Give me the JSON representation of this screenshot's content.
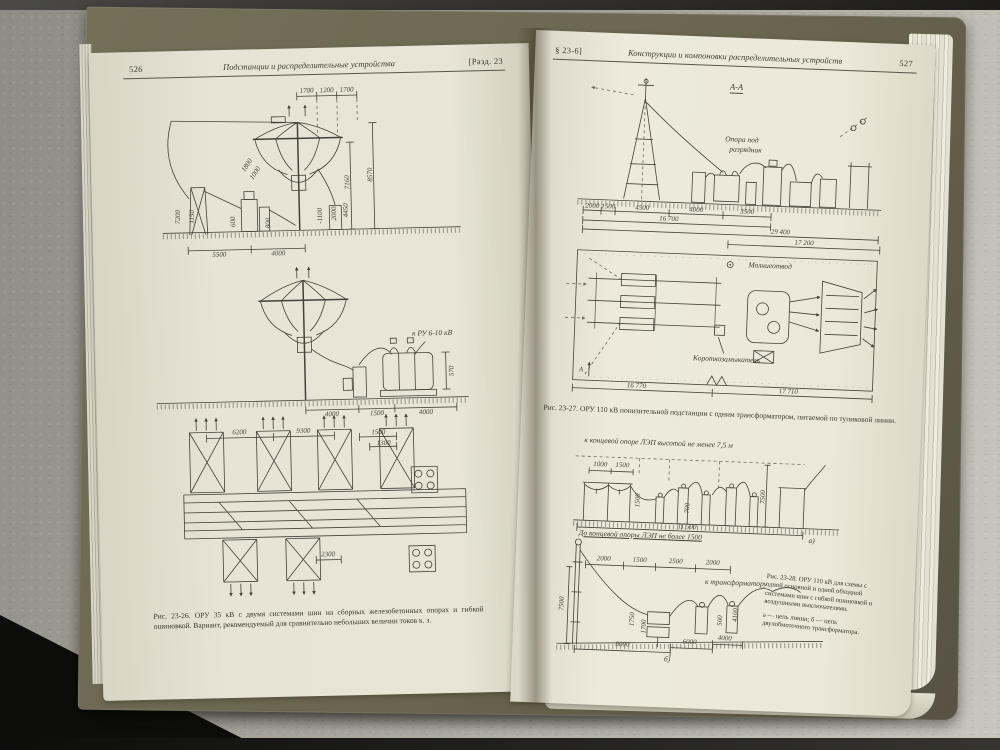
{
  "colors": {
    "cover": "#6a654f",
    "page": "#e8e5d6",
    "fabric": "#b5b2a9",
    "ink": "#44413a"
  },
  "left_page": {
    "page_number": "526",
    "header_title": "Подстанции и распределительные устройства",
    "header_section": "[Разд. 23",
    "fig1": {
      "dims_top": [
        "1700",
        "1200",
        "1700"
      ],
      "dims_left": [
        "7200",
        "1150",
        "600",
        "800"
      ],
      "dims_mid": [
        "1800",
        "1000",
        "-1100",
        "2000",
        "4450"
      ],
      "dims_right": [
        "7160",
        "8570"
      ],
      "dims_bottom": [
        "5500",
        "4000"
      ]
    },
    "fig2": {
      "label": "к РУ 6-10 кВ",
      "dim_right": "570",
      "dims_bottom": [
        "4000",
        "1500",
        "4000"
      ]
    },
    "fig3": {
      "dims_top": [
        "6200",
        "9300",
        "1500",
        "1300"
      ],
      "dim_bottom": "2300"
    },
    "caption": "Рис. 23-26. ОРУ 35 кВ с двумя системами шин на сборных железобетонных опорах и гибкой ошиновкой. Вариант, рекомендуемый для сравнительно небольших величин токов к. з."
  },
  "right_page": {
    "page_number": "527",
    "header_section": "§ 23-6]",
    "header_title": "Конструкции и компоновки распределительных устройств",
    "view_label": "А-А",
    "fig_aa": {
      "label_line1": "Опора под",
      "label_line2": "разрядник",
      "dims_bottom": [
        "2000",
        "1500",
        "4500",
        "4000",
        "3500"
      ],
      "total_1": "16 700",
      "total_2": "29 400"
    },
    "fig_plan": {
      "label_lightning": "Молниеотвод",
      "label_shorter": "Короткозамыкатель",
      "dim_top": "17 200",
      "dims_bottom": [
        "16 770",
        "17 710"
      ],
      "cut_label": "А"
    },
    "caption_27": "Рис. 23-27. ОРУ 110 кВ понизительной подстанции с одним трансформатором, питаемой по тупиковой линии.",
    "fig_a": {
      "label_top": "к концевой опоре ЛЭП высотой не менее 7,5 м",
      "dims_small": [
        "1000",
        "1500"
      ],
      "dims_v": [
        "1500",
        "700"
      ],
      "dim_height": "7500",
      "dim_total": "11 500",
      "label_bottom": "До концевой опоры ЛЭП не более 1500",
      "sub_label": "а)"
    },
    "fig_b": {
      "dims_top": [
        "2000",
        "1500",
        "2500",
        "2000"
      ],
      "dim_left": "7500",
      "dims_mid": [
        "1750",
        "1700",
        "500",
        "4100"
      ],
      "dims_bottom": [
        "8000",
        "6000",
        "4000"
      ],
      "label_transformer": "к трансформатору",
      "sub_label": "б)"
    },
    "caption_28": "Рис. 23-28. ОРУ 110 кВ для схемы с одной основной и одной обходной системами шин с гибкой ошиновкой и воздушными выключателями.",
    "caption_28_note": "а — цепь линии; б — цепь двухобмоточного трансформатора."
  }
}
